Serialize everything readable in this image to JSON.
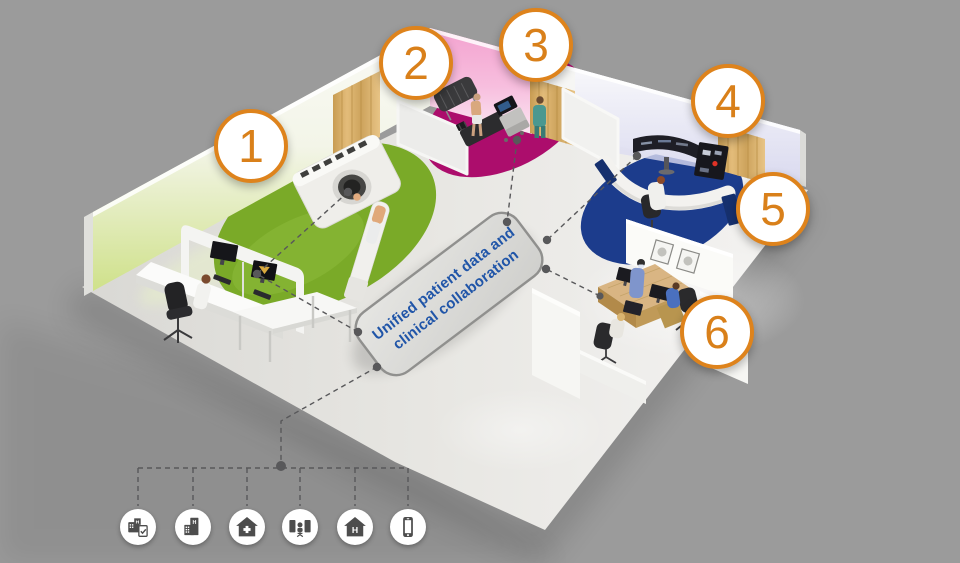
{
  "scene": {
    "background_color": "#9b9b9b",
    "platform": {
      "label_line1": "Unified patient data and",
      "label_line2": "clinical collaboration",
      "text_color": "#2055a8"
    },
    "markers": [
      {
        "label": "1"
      },
      {
        "label": "2"
      },
      {
        "label": "3"
      },
      {
        "label": "4"
      },
      {
        "label": "5"
      },
      {
        "label": "6"
      }
    ],
    "marker_color": "#de831c",
    "icons": [
      {
        "name": "hospital-report-icon"
      },
      {
        "name": "hospital-building-icon"
      },
      {
        "name": "home-care-icon"
      },
      {
        "name": "reading-room-icon"
      },
      {
        "name": "home-hospital-icon"
      },
      {
        "name": "mobile-phone-icon"
      }
    ],
    "colors": {
      "room1_rug_green": "#7aaa28",
      "room2_rug_magenta": "#ac0d6c",
      "room5_rug_blue": "#1c3c8c",
      "wall_pink": "#f3a2cf",
      "wall_green_glow": "#cfe18a",
      "wall_lavender": "#d2d2ee",
      "wood_door": "#d9b475",
      "connector_gray": "#58585a"
    }
  }
}
